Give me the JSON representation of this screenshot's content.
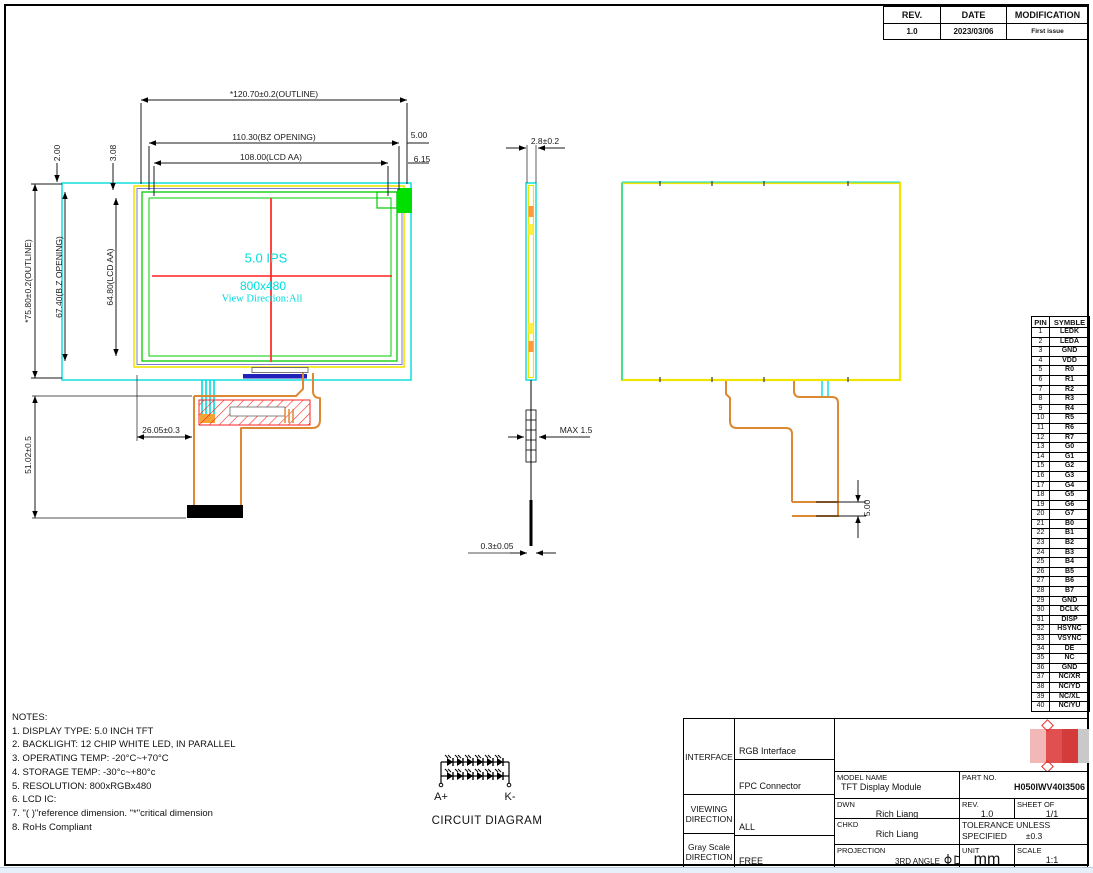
{
  "colors": {
    "cyan": "#00dcdc",
    "green": "#00cc00",
    "bright_green": "#00e000",
    "yellow": "#f0e400",
    "red": "#ff2222",
    "orange": "#dd8833",
    "navy": "#2222bb",
    "black": "#000000"
  },
  "revision_table": {
    "headers": [
      "REV.",
      "DATE",
      "MODIFICATION"
    ],
    "rev": "1.0",
    "date": "2023/03/06",
    "modification": "First issue"
  },
  "front_view": {
    "size_label": "5.0 IPS",
    "resolution": "800x480",
    "view_direction": "View Direction:All"
  },
  "dim_labels": [
    {
      "text": "*120.70±0.2(OUTLINE)",
      "x": 274,
      "y": 94,
      "rot": 0
    },
    {
      "text": "110.30(BZ OPENING)",
      "x": 274,
      "y": 137,
      "rot": 0
    },
    {
      "text": "108.00(LCD AA)",
      "x": 271,
      "y": 157,
      "rot": 0
    },
    {
      "text": "5.00",
      "x": 419,
      "y": 135,
      "rot": 0
    },
    {
      "text": "6.15",
      "x": 422,
      "y": 159,
      "rot": 0
    },
    {
      "text": "2.00",
      "x": 57,
      "y": 153,
      "rot": -90
    },
    {
      "text": "3.08",
      "x": 113,
      "y": 153,
      "rot": -90
    },
    {
      "text": "*75.80±0.2(OUTLINE)",
      "x": 28,
      "y": 281,
      "rot": -90
    },
    {
      "text": "67.40(B.Z OPENING)",
      "x": 59,
      "y": 277,
      "rot": -90
    },
    {
      "text": "64.80(LCD AA)",
      "x": 110,
      "y": 277,
      "rot": -90
    },
    {
      "text": "51.02±0.5",
      "x": 28,
      "y": 455,
      "rot": -90
    },
    {
      "text": "26.05±0.3",
      "x": 161,
      "y": 430,
      "rot": 0
    },
    {
      "text": "2.8±0.2",
      "x": 545,
      "y": 141,
      "rot": 0
    },
    {
      "text": "MAX 1.5",
      "x": 576,
      "y": 430,
      "rot": 0
    },
    {
      "text": "0.3±0.05",
      "x": 497,
      "y": 546,
      "rot": 0
    },
    {
      "text": "5.00",
      "x": 867,
      "y": 508,
      "rot": -90
    }
  ],
  "pin_table": {
    "headers": [
      "PIN",
      "SYMBLE"
    ],
    "rows": [
      [
        "1",
        "LEDK"
      ],
      [
        "2",
        "LEDA"
      ],
      [
        "3",
        "GND"
      ],
      [
        "4",
        "VDD"
      ],
      [
        "5",
        "R0"
      ],
      [
        "6",
        "R1"
      ],
      [
        "7",
        "R2"
      ],
      [
        "8",
        "R3"
      ],
      [
        "9",
        "R4"
      ],
      [
        "10",
        "R5"
      ],
      [
        "11",
        "R6"
      ],
      [
        "12",
        "R7"
      ],
      [
        "13",
        "G0"
      ],
      [
        "14",
        "G1"
      ],
      [
        "15",
        "G2"
      ],
      [
        "16",
        "G3"
      ],
      [
        "17",
        "G4"
      ],
      [
        "18",
        "G5"
      ],
      [
        "19",
        "G6"
      ],
      [
        "20",
        "G7"
      ],
      [
        "21",
        "B0"
      ],
      [
        "22",
        "B1"
      ],
      [
        "23",
        "B2"
      ],
      [
        "24",
        "B3"
      ],
      [
        "25",
        "B4"
      ],
      [
        "26",
        "B5"
      ],
      [
        "27",
        "B6"
      ],
      [
        "28",
        "B7"
      ],
      [
        "29",
        "GND"
      ],
      [
        "30",
        "DCLK"
      ],
      [
        "31",
        "DISP"
      ],
      [
        "32",
        "HSYNC"
      ],
      [
        "33",
        "VSYNC"
      ],
      [
        "34",
        "DE"
      ],
      [
        "35",
        "NC"
      ],
      [
        "36",
        "GND"
      ],
      [
        "37",
        "NC/XR"
      ],
      [
        "38",
        "NC/YD"
      ],
      [
        "39",
        "NC/XL"
      ],
      [
        "40",
        "NC/YU"
      ]
    ]
  },
  "notes": {
    "title": "NOTES:",
    "lines": [
      "1. DISPLAY TYPE: 5.0 INCH TFT",
      "2. BACKLIGHT: 12 CHIP WHITE LED, IN PARALLEL",
      " 3. OPERATING TEMP: -20°C~+70°C",
      "4. STORAGE TEMP: -30°c~+80°c",
      "5. RESOLUTION: 800xRGBx480",
      "6. LCD IC:",
      "7. \"( )\"reference dimension. \"*\"critical dimension",
      "8. RoHs Compliant"
    ]
  },
  "circuit": {
    "anode_label": "A+",
    "cathode_label": "K-",
    "caption": "CIRCUIT DIAGRAM"
  },
  "title_block": {
    "interface_label": "INTERFACE",
    "interface_value1": "RGB Interface",
    "interface_value2": "FPC Connector",
    "viewing_label1": "VIEWING",
    "viewing_label2": "DIRECTION",
    "viewing_value": "ALL",
    "gray_label1": "Gray Scale",
    "gray_label2": "DIRECTION",
    "gray_value": "FREE",
    "model_name_label": "MODEL NAME",
    "model_name": "TFT Display Module",
    "part_no_label": "PART NO.",
    "part_no": "H050IWV40I3506",
    "dwn_label": "DWN",
    "dwn": "Rich Liang",
    "rev_label": "REV.",
    "rev": "1.0",
    "sheet_label": "SHEET OF",
    "sheet": "1/1",
    "chkd_label": "CHKD",
    "chkd": "Rich Liang",
    "tolerance_label1": "TOLERANCE UNLESS",
    "tolerance_label2": "SPECIFIED",
    "tolerance_value": "±0.3",
    "projection_label": "PROJECTION",
    "projection_value": "3RD ANGLE",
    "unit_label": "UNIT",
    "unit_value": "mm",
    "scale_label": "SCALE",
    "scale_value": "1:1",
    "logo_blocks": [
      "#f2b8b8",
      "#e05050",
      "#d43c3c",
      "#c9c9c9",
      "#6e6e6e",
      "#4f4f4f",
      "#5a5a5a",
      "#4a4a4a",
      "#606060",
      "#555555",
      "#6b6b6b",
      "#8f8f8f"
    ]
  }
}
